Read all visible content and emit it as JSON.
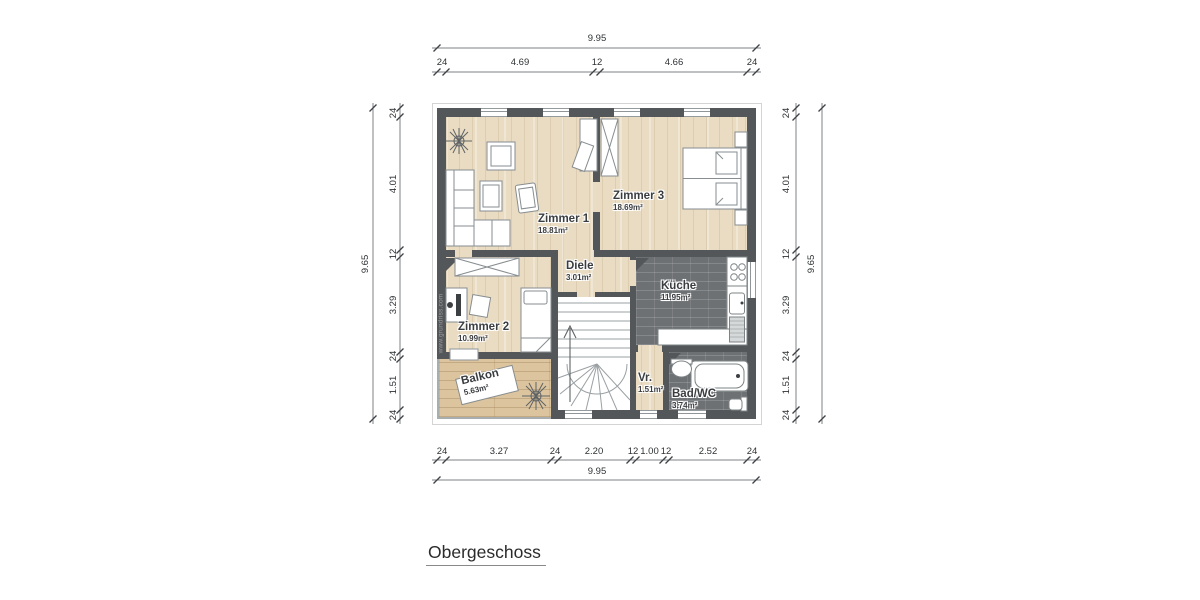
{
  "title": "Obergeschoss",
  "watermark": "www.grundriss.com",
  "plan": {
    "rooms": [
      {
        "name": "Zimmer 1",
        "area": "18.81m²"
      },
      {
        "name": "Zimmer 3",
        "area": "18.69m²"
      },
      {
        "name": "Diele",
        "area": "3.01m²"
      },
      {
        "name": "Küche",
        "area": "11.95m²"
      },
      {
        "name": "Zimmer 2",
        "area": "10.99m²"
      },
      {
        "name": "Balkon",
        "area": "5.63m²"
      },
      {
        "name": "Vr.",
        "area": "1.51m²"
      },
      {
        "name": "Bad/WC",
        "area": "3.74m²"
      }
    ]
  },
  "dimensions": {
    "top": {
      "overall": "9.95",
      "segments": [
        "24",
        "4.69",
        "12",
        "4.66",
        "24"
      ]
    },
    "bottom": {
      "overall": "9.95",
      "segments": [
        "24",
        "3.27",
        "24",
        "2.20",
        "12",
        "1.00",
        "12",
        "2.52",
        "24"
      ]
    },
    "left": {
      "overall": "9.65",
      "segments": [
        "24",
        "4.01",
        "12",
        "3.29",
        "24",
        "1.51",
        "24"
      ]
    },
    "right": {
      "overall": "9.65",
      "segments": [
        "24",
        "4.01",
        "12",
        "3.29",
        "24",
        "1.51",
        "24"
      ]
    }
  },
  "colors": {
    "wall": "#54575a",
    "wood_floor": "#e9dcc2",
    "balcony_floor": "#dcc49e",
    "tile_floor": "#6e7174",
    "furniture_line": "#878d90"
  }
}
